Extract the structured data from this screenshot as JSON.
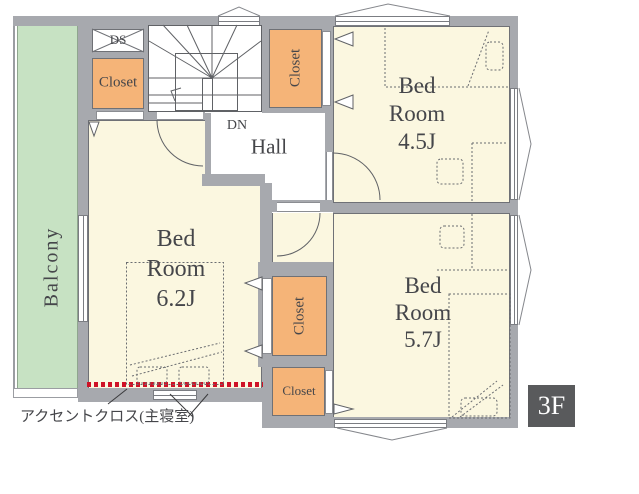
{
  "floor_badge": "3F",
  "balcony": {
    "label": "Balcony"
  },
  "hall": {
    "label": "Hall"
  },
  "stairs": {
    "down_label": "DN"
  },
  "duct": {
    "label": "DS"
  },
  "bedrooms": {
    "master": {
      "lines": [
        "Bed",
        "Room",
        "6.2J"
      ]
    },
    "east": {
      "lines": [
        "Bed",
        "Room",
        "4.5J"
      ]
    },
    "south": {
      "lines": [
        "Bed",
        "Room",
        "5.7J"
      ]
    }
  },
  "closets": {
    "top_left": {
      "label": "Closet"
    },
    "top_center": {
      "label": "Closet"
    },
    "center": {
      "label": "Closet"
    },
    "bottom": {
      "label": "Closet"
    }
  },
  "annotation": {
    "label": "アクセントクロス(主寝室)"
  },
  "colors": {
    "wall": "#a7a9ae",
    "room": "#fbf7e0",
    "closet": "#f5b478",
    "balcony": "#c7e2c3",
    "accent": "#cf1126",
    "line": "#606266",
    "text": "#45464a",
    "badge-bg": "#595a5c"
  }
}
